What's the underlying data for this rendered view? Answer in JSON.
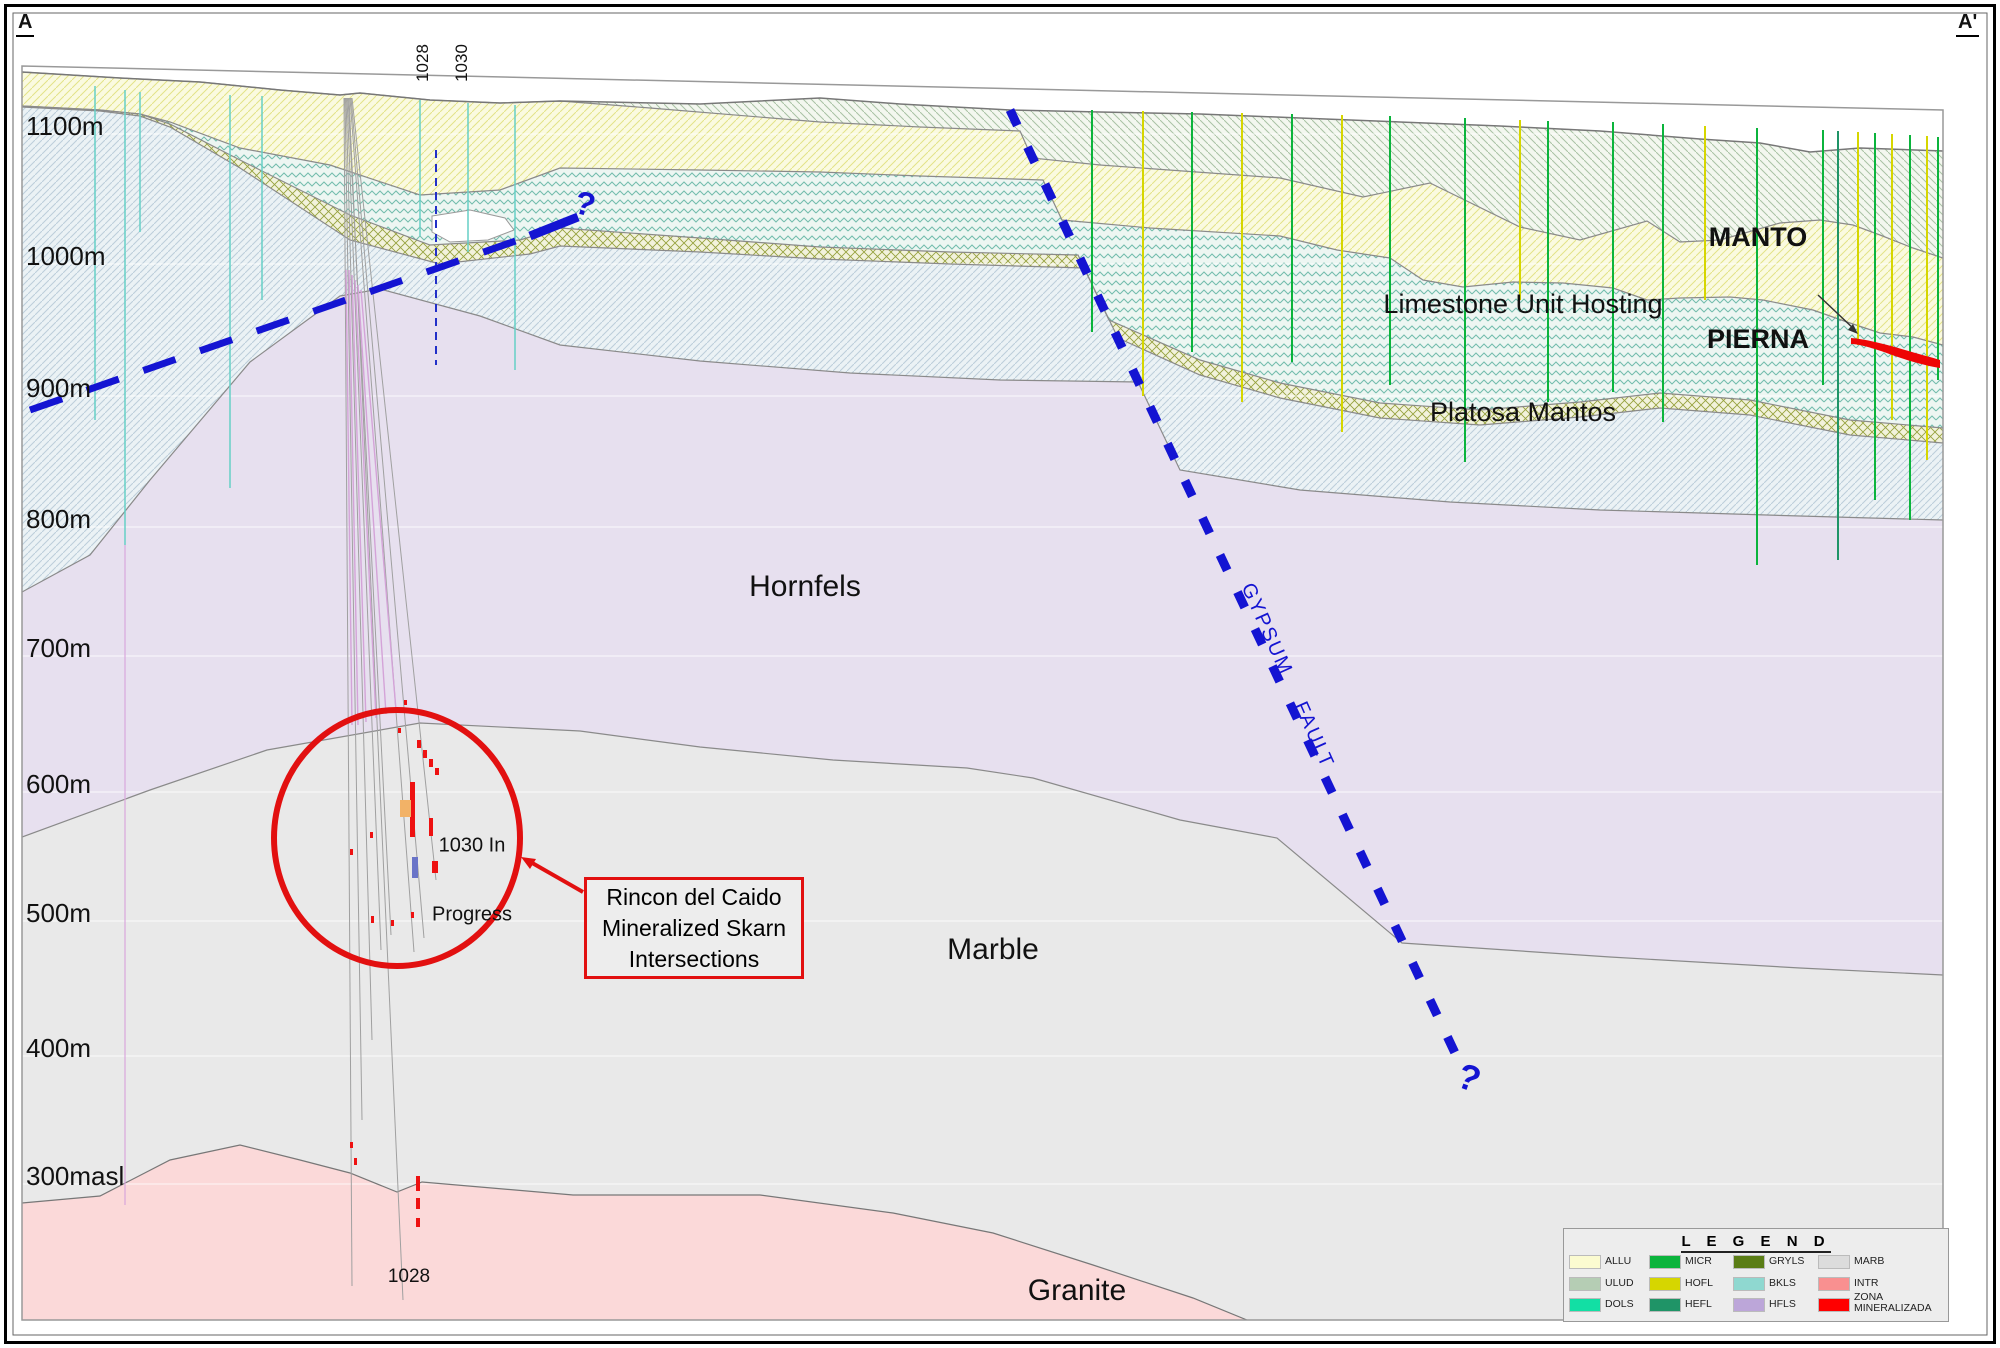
{
  "header": {
    "left_label": "A",
    "right_label": "A'"
  },
  "elevation_labels": [
    "1100m",
    "1000m",
    "900m",
    "800m",
    "700m",
    "600m",
    "500m",
    "400m",
    "300masl"
  ],
  "drill_labels": {
    "top": [
      "1028",
      "1030"
    ],
    "bottom": "1028"
  },
  "unit_labels": {
    "hornfels": "Hornfels",
    "marble": "Marble",
    "granite": "Granite",
    "limestone_line1": "Limestone Unit Hosting",
    "limestone_line2": "Platosa Mantos",
    "manto_line1": "MANTO",
    "manto_line2": "PIERNA"
  },
  "fault": {
    "name": "GYPSUM  FAULT",
    "question_mark_upper": "?",
    "question_mark_lower": "?"
  },
  "annotations": {
    "in_progress_line1": "1030 In",
    "in_progress_line2": "Progress",
    "skarn_line1": "Rincon del Caido",
    "skarn_line2": "Mineralized Skarn",
    "skarn_line3": "Intersections"
  },
  "legend": {
    "title": "L E G E N D",
    "columns": [
      [
        {
          "code": "ALLU",
          "color": "#FBFBD0"
        },
        {
          "code": "ULUD",
          "color": "#B5CDB4"
        },
        {
          "code": "DOLS",
          "color": "#12DFA4"
        }
      ],
      [
        {
          "code": "MICR",
          "color": "#0BB43C"
        },
        {
          "code": "HOFL",
          "color": "#D6D600"
        },
        {
          "code": "HEFL",
          "color": "#1F9467"
        }
      ],
      [
        {
          "code": "GRYLS",
          "color": "#5A7D15"
        },
        {
          "code": "BKLS",
          "color": "#8FD8D0"
        },
        {
          "code": "HFLS",
          "color": "#BCA6D9"
        }
      ],
      [
        {
          "code": "MARB",
          "color": "#DCDCDC"
        },
        {
          "code": "INTR",
          "color": "#F99090"
        },
        {
          "code": "ZONA MINERALIZADA",
          "color": "#FF0000"
        }
      ]
    ]
  },
  "colors": {
    "fault_blue": "#1414D2",
    "annotation_red": "#E21010",
    "mineral_red": "#EE0505",
    "drill_green": "#0BB43C",
    "drill_yellow": "#D6D600",
    "drill_teal": "#1F9467",
    "drill_cyan": "#66CFC6",
    "drill_magenta": "#D4A3D8"
  },
  "drill_holes": [
    [
      95,
      86,
      95,
      420,
      "#66CFC6",
      1.5
    ],
    [
      125,
      90,
      125,
      545,
      "#66CFC6",
      1.5
    ],
    [
      140,
      92,
      140,
      232,
      "#66CFC6",
      1.5
    ],
    [
      230,
      95,
      230,
      488,
      "#66CFC6",
      1.5
    ],
    [
      262,
      96,
      262,
      300,
      "#66CFC6",
      1.5
    ],
    [
      420,
      100,
      420,
      236,
      "#66CFC6",
      1.5
    ],
    [
      468,
      103,
      468,
      252,
      "#66CFC6",
      1.5
    ],
    [
      515,
      105,
      515,
      370,
      "#66CFC6",
      1.5
    ],
    [
      125,
      545,
      125,
      1205,
      "#D9A7DC",
      1.2
    ],
    [
      436,
      150,
      436,
      365,
      "#2230C8",
      2,
      "8 6"
    ],
    [
      1838,
      226,
      1838,
      244,
      "#2233BB",
      2
    ],
    [
      1892,
      238,
      1892,
      252,
      "#2233BB",
      2
    ],
    [
      1092,
      110,
      1092,
      332,
      "#0BB43C",
      2
    ],
    [
      1143,
      111,
      1143,
      396,
      "#D6D600",
      2
    ],
    [
      1192,
      112,
      1192,
      352,
      "#0BB43C",
      2
    ],
    [
      1242,
      113,
      1242,
      402,
      "#D6D600",
      2
    ],
    [
      1292,
      114,
      1292,
      362,
      "#0BB43C",
      2
    ],
    [
      1342,
      115,
      1342,
      432,
      "#D6D600",
      2
    ],
    [
      1390,
      116,
      1390,
      385,
      "#0BB43C",
      2
    ],
    [
      1465,
      118,
      1465,
      462,
      "#0BB43C",
      2
    ],
    [
      1520,
      120,
      1520,
      300,
      "#D6D600",
      2
    ],
    [
      1548,
      121,
      1548,
      402,
      "#0BB43C",
      2
    ],
    [
      1613,
      122,
      1613,
      392,
      "#0BB43C",
      2
    ],
    [
      1663,
      124,
      1663,
      422,
      "#0BB43C",
      2
    ],
    [
      1705,
      126,
      1705,
      300,
      "#D6D600",
      2
    ],
    [
      1757,
      128,
      1757,
      565,
      "#0BB43C",
      2
    ],
    [
      1823,
      130,
      1823,
      385,
      "#0BB43C",
      2
    ],
    [
      1838,
      131,
      1838,
      560,
      "#1F9467",
      2
    ],
    [
      1858,
      132,
      1858,
      345,
      "#D6D600",
      2
    ],
    [
      1875,
      133,
      1875,
      500,
      "#0BB43C",
      2
    ],
    [
      1892,
      134,
      1892,
      420,
      "#D6D600",
      2
    ],
    [
      1910,
      135,
      1910,
      520,
      "#0BB43C",
      2
    ],
    [
      1927,
      136,
      1927,
      460,
      "#D6D600",
      2
    ],
    [
      1938,
      137,
      1938,
      380,
      "#0BB43C",
      2
    ]
  ],
  "pad_traces": [
    [
      344,
      98,
      352,
      1286
    ],
    [
      345,
      98,
      362,
      1120
    ],
    [
      346,
      98,
      372,
      1040
    ],
    [
      347,
      98,
      381,
      950
    ],
    [
      348,
      98,
      391,
      935
    ],
    [
      349,
      98,
      403,
      1300
    ],
    [
      350,
      98,
      414,
      952
    ],
    [
      351,
      98,
      424,
      938
    ],
    [
      352,
      98,
      436,
      880
    ]
  ],
  "magenta_traces": [
    [
      346,
      270,
      352,
      725
    ],
    [
      349,
      270,
      358,
      725
    ],
    [
      352,
      275,
      366,
      722
    ],
    [
      355,
      280,
      376,
      718
    ],
    [
      358,
      285,
      386,
      714
    ],
    [
      361,
      290,
      396,
      710
    ]
  ],
  "intercepts": [
    [
      410,
      782,
      5,
      55
    ],
    [
      429,
      818,
      4,
      18
    ],
    [
      417,
      740,
      4,
      8
    ],
    [
      423,
      750,
      4,
      8
    ],
    [
      429,
      759,
      4,
      8
    ],
    [
      435,
      768,
      4,
      7
    ],
    [
      432,
      861,
      6,
      12
    ],
    [
      350,
      849,
      3,
      6
    ],
    [
      370,
      832,
      3,
      6
    ],
    [
      371,
      916,
      3,
      7
    ],
    [
      391,
      920,
      3,
      6
    ],
    [
      411,
      912,
      3,
      6
    ],
    [
      404,
      700,
      3,
      5
    ],
    [
      398,
      728,
      3,
      5
    ],
    [
      416,
      1176,
      4,
      15
    ],
    [
      416,
      1198,
      4,
      11
    ],
    [
      416,
      1218,
      4,
      9
    ],
    [
      350,
      1142,
      3,
      6
    ],
    [
      354,
      1158,
      3,
      7
    ],
    [
      400,
      800,
      11,
      17,
      "#F2B267"
    ],
    [
      412,
      857,
      6,
      21,
      "#6A74C8"
    ]
  ]
}
